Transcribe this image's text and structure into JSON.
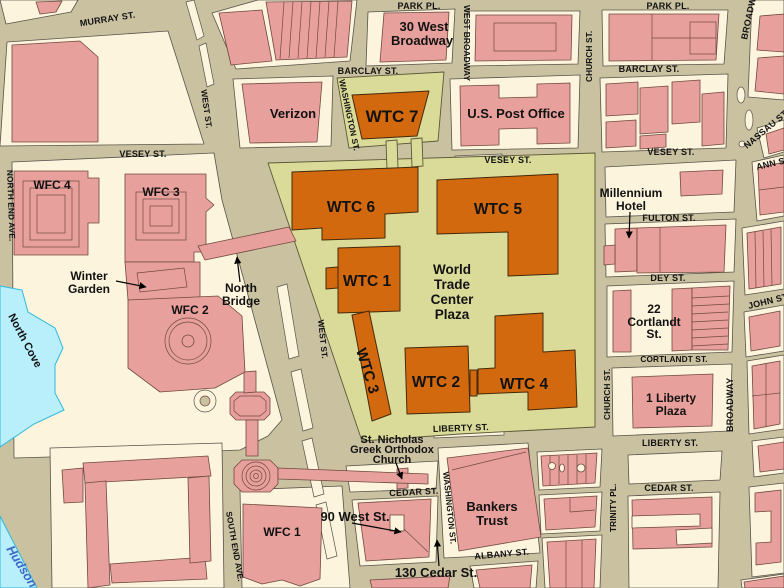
{
  "colors": {
    "street": "#cac1a0",
    "block": "#fcf4dc",
    "building": "#e7a09c",
    "wtc_orange": "#d2690e",
    "plaza": "#dbdb99",
    "water": "#b9eefb",
    "water_edge": "#2fb8dc",
    "hudson_text": "#3c68c8",
    "label_text": "#121212"
  },
  "streets": {
    "murray": "MURRAY ST.",
    "park_pl_w": "PARK PL.",
    "park_pl_e": "PARK PL.",
    "west_broadway": "WEST BROADWAY",
    "barclay_w": "BARCLAY ST.",
    "barclay_e": "BARCLAY ST.",
    "washington_n": "WASHINGTON ST.",
    "washington_s": "WASHINGTON ST.",
    "west_n": "WEST ST.",
    "west_mid": "WEST ST.",
    "vesey_w": "VESEY ST.",
    "vesey_mid": "VESEY ST.",
    "vesey_e": "VESEY ST.",
    "church_n": "CHURCH ST.",
    "church_s": "CHURCH ST.",
    "broadway_n": "BROADWAY",
    "broadway_s": "BROADWAY",
    "nassau": "NASSAU ST.",
    "ann": "ANN ST.",
    "john": "JOHN ST.",
    "fulton": "FULTON ST.",
    "dey": "DEY ST.",
    "cortlandt": "CORTLANDT ST.",
    "liberty_w": "LIBERTY ST.",
    "liberty_e": "LIBERTY ST.",
    "cedar_w": "CEDAR ST.",
    "cedar_e": "CEDAR ST.",
    "albany": "ALBANY ST.",
    "trinity_pl": "TRINITY PL.",
    "north_end_ave": "NORTH END AVE.",
    "south_end_ave": "SOUTH END AVE."
  },
  "buildings": {
    "wtc1": "WTC 1",
    "wtc2": "WTC 2",
    "wtc3": "WTC 3",
    "wtc4": "WTC 4",
    "wtc5": "WTC 5",
    "wtc6": "WTC 6",
    "wtc7": "WTC 7",
    "plaza_line1": "World",
    "plaza_line2": "Trade",
    "plaza_line3": "Center",
    "plaza_line4": "Plaza",
    "verizon": "Verizon",
    "post_office": "U.S. Post Office",
    "west30_line1": "30 West",
    "west30_line2": "Broadway",
    "millennium_line1": "Millennium",
    "millennium_line2": "Hotel",
    "wfc1": "WFC 1",
    "wfc2": "WFC 2",
    "wfc3": "WFC 3",
    "wfc4": "WFC 4",
    "winter_line1": "Winter",
    "winter_line2": "Garden",
    "north_bridge_line1": "North",
    "north_bridge_line2": "Bridge",
    "cortlandt22_line1": "22",
    "cortlandt22_line2": "Cortlandt",
    "cortlandt22_line3": "St.",
    "liberty1_line1": "1 Liberty",
    "liberty1_line2": "Plaza",
    "bankers_line1": "Bankers",
    "bankers_line2": "Trust",
    "st_nicholas_line1": "St. Nicholas",
    "st_nicholas_line2": "Greek Orthodox",
    "st_nicholas_line3": "Church",
    "west90": "90 West St.",
    "cedar130": "130 Cedar St."
  },
  "water": {
    "north_cove": "North Cove",
    "hudson": "Hudson"
  }
}
